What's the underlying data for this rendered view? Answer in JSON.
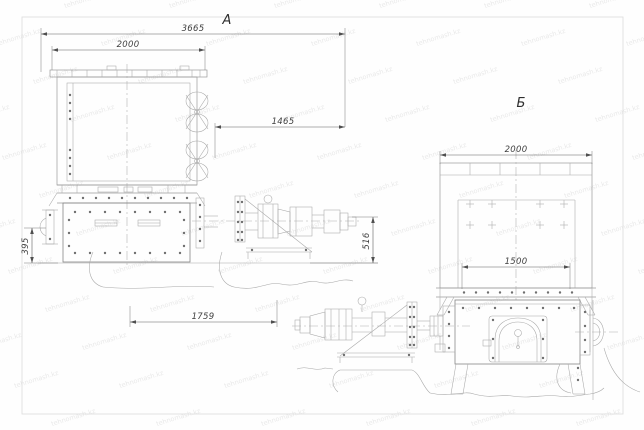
{
  "page": {
    "type": "technical-drawing",
    "background_color": "#fefefe",
    "sheet_border_color": "#dedede",
    "line_color": "#9b9b9b",
    "dimension_color": "#5d5d5d"
  },
  "watermark": {
    "text": "tehnomash.kz",
    "color": "#9e9e9e",
    "opacity": 0.22,
    "angle_deg": -17
  },
  "view_a": {
    "label": "А",
    "dims": {
      "overall_width": "3665",
      "hopper_width": "2000",
      "right_offset": "1465",
      "bracket_height": "395",
      "shaft_height": "516",
      "base_length": "1759"
    }
  },
  "view_b": {
    "label": "Б",
    "dims": {
      "hopper_width": "2000",
      "flange_span": "1500"
    }
  }
}
